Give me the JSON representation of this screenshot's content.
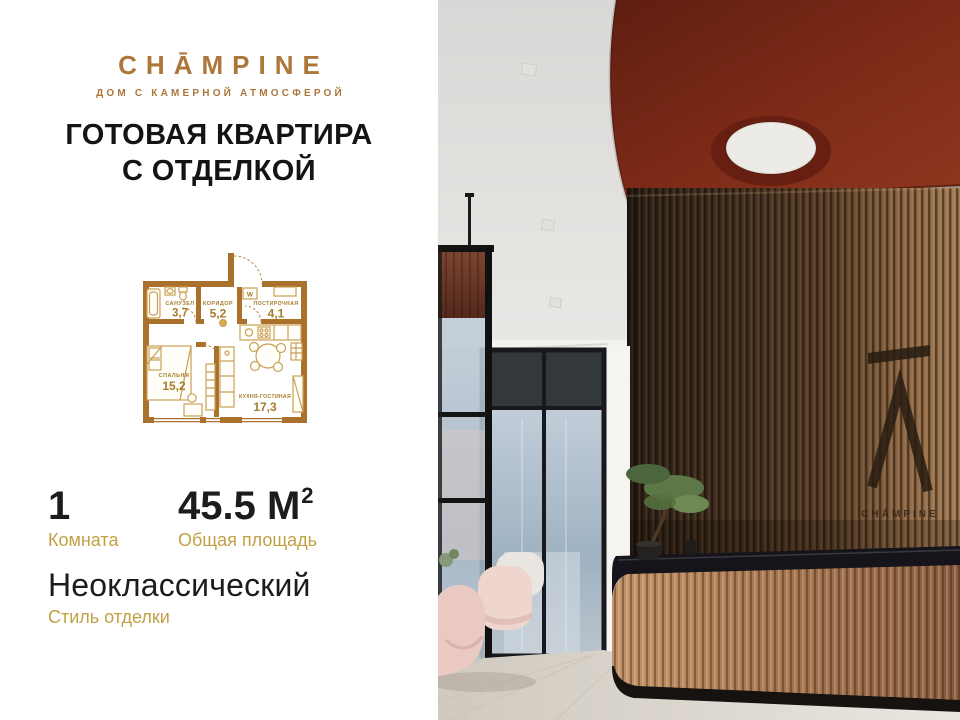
{
  "brand": {
    "logo_text": "CHĀMPINE",
    "tagline": "ДОМ С КАМЕРНОЙ АТМОСФЕРОЙ",
    "color_bronze": "#ad763a"
  },
  "headline": {
    "line1": "ГОТОВАЯ КВАРТИРА",
    "line2": "С ОТДЕЛКОЙ"
  },
  "floor_plan": {
    "wall_color": "#a9712c",
    "furniture_color": "#c9a055",
    "label_color": "#a57c2b",
    "washer_label": "W",
    "rooms": [
      {
        "name": "САНУЗЕЛ",
        "area": "3,7"
      },
      {
        "name": "КОРИДОР",
        "area": "5,2"
      },
      {
        "name": "ПОСТИРОЧНАЯ",
        "area": "4,1"
      },
      {
        "name": "СПАЛЬНЯ",
        "area": "15,2"
      },
      {
        "name": "КУХНЯ-ГОСТИНАЯ",
        "area": "17,3"
      }
    ]
  },
  "stats": {
    "rooms": {
      "value": "1",
      "label": "Комната"
    },
    "area": {
      "value": "45.5 М",
      "sup": "2",
      "label": "Общая площадь"
    },
    "style": {
      "value": "Неоклассический",
      "label": "Стиль отделки"
    },
    "label_color": "#c2a145",
    "value_color": "#1d1c1a"
  },
  "photo": {
    "wall_logo_text": "CHĀMPINE",
    "colors": {
      "ceiling_red": "#7c2a17",
      "wood_wall_dark": "#43301f",
      "wood_wall_light": "#a77e55",
      "desk_tan": "#aa7b54",
      "counter_dark": "#15141a",
      "floor": "#dcd8d0",
      "glass_blue": "#9fb2c2",
      "pink_chair": "#e9c9c1"
    }
  }
}
